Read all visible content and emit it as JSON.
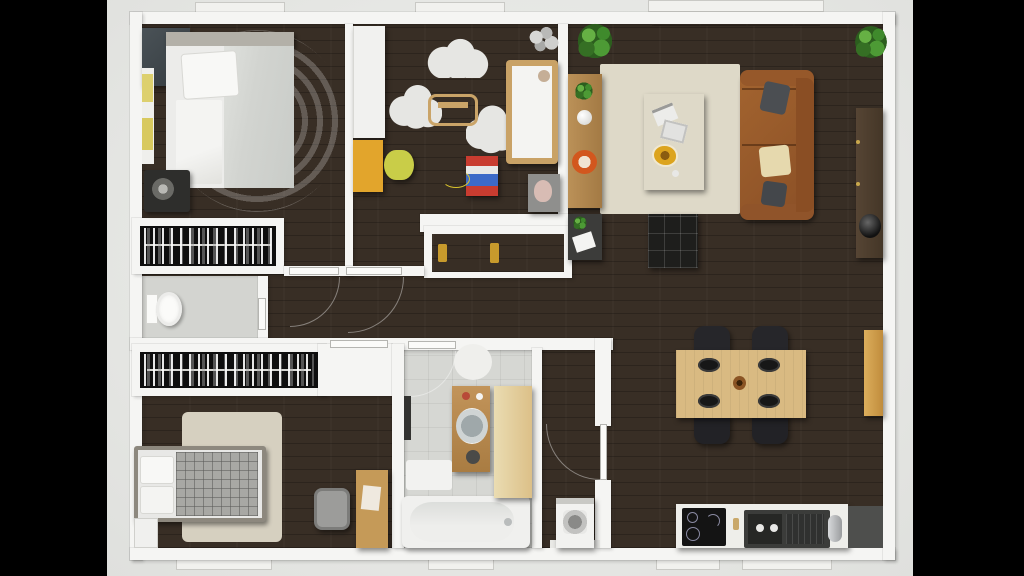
{
  "scene": {
    "type": "3d-floor-plan-render",
    "view": "top-down",
    "framing": "letterboxed-black-bars",
    "visible_text": "none"
  },
  "colors": {
    "letterbox": "#000000",
    "canvas": "#e8e9e6",
    "wall": "#f5f5f3",
    "wood_floor": "#382e25",
    "tile_floor": "#d6d7d3",
    "closet_interior": "#0f0f0f",
    "rug_beige": "#cdc6b4",
    "rug_cream": "#ded9c8",
    "sofa_leather": "#9a5c32",
    "accent_yellow": "#e2a52c",
    "accent_yellow_green": "#c9cd48",
    "dining_wood": "#d9ba82",
    "cabinet_gold": "#cfa04e",
    "vanity_wood": "#b9894e",
    "media_console_wood": "#4b3b2b",
    "plant_green": "#4d9a35",
    "chair_black": "#26262a",
    "orange_plate": "#d2571e",
    "dumbbell_gold": "#d9b44a",
    "dumbbell_blue": "#3f5fb0"
  },
  "rooms": [
    {
      "name": "master-bedroom",
      "position": "top-left",
      "furniture": [
        "double-bed-white-duvet",
        "round-swirl-rug",
        "dresser",
        "bench-with-yellow-pillows",
        "floor-fan",
        "walk-in-clothes-rack"
      ]
    },
    {
      "name": "kids-room",
      "position": "top-middle",
      "furniture": [
        "white-wardrobe",
        "yellow-desk",
        "yellow-green-chair",
        "cloud-rugs-x3",
        "wooden-rocking-toy",
        "crib",
        "toy-cart",
        "pendant-lamp",
        "teddy-bear-on-box"
      ]
    },
    {
      "name": "living-room",
      "position": "top-right",
      "furniture": [
        "cream-area-rug",
        "dark-coffee-table",
        "leather-sofa",
        "tufted-ottoman",
        "shelf-console",
        "low-cabinet",
        "media-console",
        "speaker",
        "plant-top-left",
        "plant-top-right"
      ]
    },
    {
      "name": "dining-area",
      "position": "right",
      "furniture": [
        "wood-dining-table",
        "black-chairs-x4",
        "black-plates-x4",
        "wine-bottle",
        "tall-gold-cabinet"
      ]
    },
    {
      "name": "kitchen",
      "position": "bottom-right",
      "furniture": [
        "white-counter",
        "black-cooktop",
        "dark-double-sink",
        "faucet",
        "dark-counter"
      ]
    },
    {
      "name": "bathroom",
      "position": "bottom-middle",
      "furniture": [
        "wood-vanity-with-round-sink",
        "bathtub",
        "beige-cabinet",
        "bath-mat",
        "round-rug",
        "wall-radiator"
      ]
    },
    {
      "name": "wc",
      "position": "middle-left",
      "furniture": [
        "toilet"
      ]
    },
    {
      "name": "bedroom-2",
      "position": "bottom-left",
      "furniture": [
        "bed-plaid-blanket",
        "beige-rug",
        "wood-desk",
        "gray-chair",
        "nightstand",
        "clothes-rack"
      ]
    },
    {
      "name": "hallway",
      "position": "center",
      "furniture": [
        "storage-niche-with-two-dumbbells"
      ]
    },
    {
      "name": "laundry-nook",
      "position": "bottom-center",
      "furniture": [
        "washing-machine"
      ]
    }
  ],
  "openings": {
    "windows_top": 3,
    "windows_bottom": 4,
    "interior_doors": 6
  }
}
